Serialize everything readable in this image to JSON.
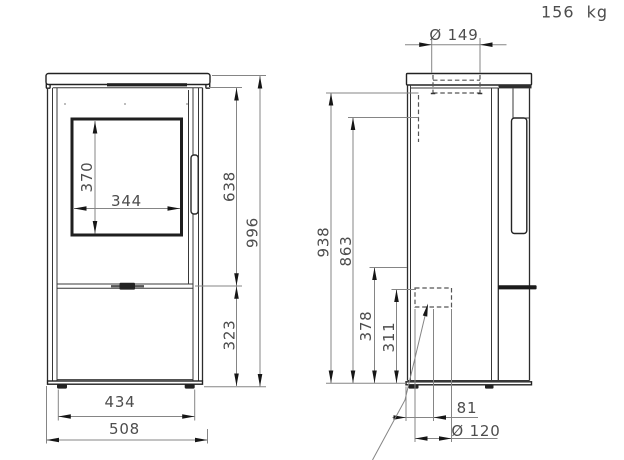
{
  "title_block": {
    "weight": "156 kg"
  },
  "front_view": {
    "dimensions": {
      "glass_height": "370",
      "glass_width": "344",
      "door_section_height": "638",
      "overall_height": "996",
      "base_section_height": "323",
      "feet_spacing": "434",
      "overall_width": "508"
    }
  },
  "side_view": {
    "dimensions": {
      "flue_collar_diameter": "Ø 149",
      "rear_flue_top_height": "938",
      "rear_flue_height": "863",
      "air_inlet_top_height": "378",
      "air_inlet_height": "311",
      "air_inlet_offset_from_back": "81",
      "air_inlet_diameter": "Ø 120"
    }
  }
}
